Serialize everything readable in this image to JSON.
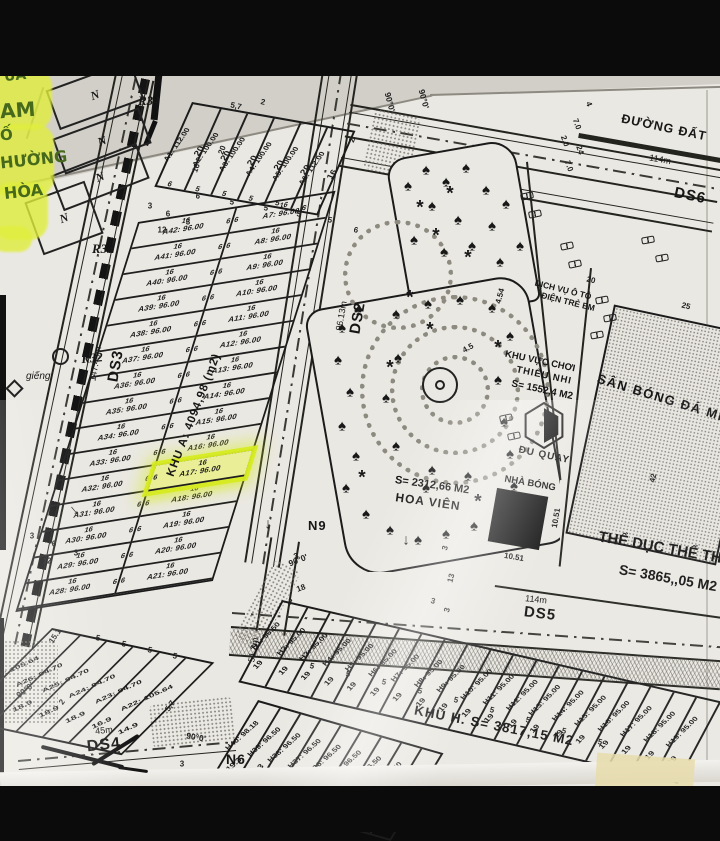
{
  "handwriting": {
    "l1": "ỦA",
    "l2": "AM",
    "l3": "Ố",
    "l4": "HƯỜNG",
    "l5": "HÒA"
  },
  "plot_marker": "N",
  "ref_labels": {
    "r34": "R34",
    "r33": "R33",
    "r32": "R32",
    "well": "giếng"
  },
  "roads": {
    "ds2": {
      "name": "DS2",
      "length": "96.13m"
    },
    "ds3": {
      "name": "DS3",
      "length": "147.43m"
    },
    "ds4": {
      "name": "DS4",
      "length": "45m"
    },
    "ds5": {
      "name": "DS5",
      "length": "114m"
    },
    "ds6": {
      "name": "DS6"
    },
    "dirt": {
      "name": "ĐƯỜNG ĐẤT",
      "length": "114m"
    },
    "n6": "N6",
    "n9": "N9",
    "len51": "51.3m"
  },
  "block_a": {
    "name": "KHU A: 4094,98 (m2)",
    "top_row": [
      {
        "label": "A1: 112.00",
        "depth": "20",
        "w": "6"
      },
      {
        "label": "A2: 100.00",
        "depth": "20",
        "w": "5"
      },
      {
        "label": "A3: 100.00",
        "depth": "20",
        "w": "5"
      },
      {
        "label": "A4: 100.00",
        "depth": "20",
        "w": "5"
      },
      {
        "label": "A5: 100.00",
        "depth": "20",
        "w": "5"
      },
      {
        "label": "A6: 112.00",
        "depth": "16",
        "w": "6"
      }
    ],
    "left_col": [
      {
        "label": "A42: 96.00",
        "w": "16",
        "d": "6"
      },
      {
        "label": "A41: 96.00",
        "w": "16",
        "d": "6"
      },
      {
        "label": "A40: 96.00",
        "w": "16",
        "d": "6"
      },
      {
        "label": "A39: 96.00",
        "w": "16",
        "d": "6"
      },
      {
        "label": "A38: 96.00",
        "w": "16",
        "d": "6"
      },
      {
        "label": "A37: 96.00",
        "w": "16",
        "d": "6"
      },
      {
        "label": "A36: 96.00",
        "w": "16",
        "d": "6"
      },
      {
        "label": "A35: 96.00",
        "w": "16",
        "d": "6"
      },
      {
        "label": "A34: 96.00",
        "w": "16",
        "d": "6"
      },
      {
        "label": "A33: 96.00",
        "w": "16",
        "d": "6"
      },
      {
        "label": "A32: 96.00",
        "w": "16",
        "d": "6"
      },
      {
        "label": "A31: 96.00",
        "w": "16",
        "d": "6"
      },
      {
        "label": "A30: 96.00",
        "w": "16",
        "d": "6"
      },
      {
        "label": "A29: 96.00",
        "w": "16",
        "d": "6"
      },
      {
        "label": "A28: 96.00",
        "w": "16",
        "d": "6"
      }
    ],
    "right_col": [
      {
        "label": "A7: 96.00",
        "w": "16",
        "d": "6"
      },
      {
        "label": "A8: 96.00",
        "w": "16",
        "d": "6"
      },
      {
        "label": "A9: 96.00",
        "w": "16",
        "d": "6"
      },
      {
        "label": "A10: 96.00",
        "w": "16",
        "d": "6"
      },
      {
        "label": "A11: 96.00",
        "w": "16",
        "d": "6"
      },
      {
        "label": "A12: 96.00",
        "w": "16",
        "d": "6"
      },
      {
        "label": "A13: 96.00",
        "w": "16",
        "d": "6"
      },
      {
        "label": "A14: 96.00",
        "w": "16",
        "d": "6"
      },
      {
        "label": "A15: 96.00",
        "w": "16",
        "d": "6"
      },
      {
        "label": "A16: 96.00",
        "w": "16",
        "d": "6"
      },
      {
        "label": "A17: 96.00",
        "w": "16",
        "d": "6",
        "cls": "hl"
      },
      {
        "label": "A18: 96.00",
        "w": "16",
        "d": "6",
        "cls": "hl2"
      },
      {
        "label": "A19: 96.00",
        "w": "16",
        "d": "6"
      },
      {
        "label": "A20: 96.00",
        "w": "16",
        "d": "6"
      },
      {
        "label": "A21: 96.00",
        "w": "16",
        "d": "6"
      }
    ],
    "diag_row": [
      {
        "label": "A27: 105.64",
        "w": "18.9"
      },
      {
        "label": "A26: 94.70",
        "w": "18.9"
      },
      {
        "label": "A25: 94.70",
        "w": "18.9"
      },
      {
        "label": "A24: 94.70",
        "w": "18.9"
      },
      {
        "label": "A23: 94.70",
        "w": "16.9"
      },
      {
        "label": "A22: 105.64",
        "w": "14.9"
      }
    ]
  },
  "block_h": {
    "name": "KHU H. S= 3817,15 M2",
    "upper_row": [
      {
        "label": "H1: 96.50",
        "w": "19"
      },
      {
        "label": "H2: 95.00",
        "w": "19"
      },
      {
        "label": "H3: 95.00",
        "w": "19"
      },
      {
        "label": "H4: 95.00",
        "w": "19"
      },
      {
        "label": "H5: 95.00",
        "w": "19"
      },
      {
        "label": "H6: 95.00",
        "w": "19"
      },
      {
        "label": "H7: 95.00",
        "w": "19"
      },
      {
        "label": "H8: 95.00",
        "w": "19"
      },
      {
        "label": "H9: 95.00",
        "w": "19"
      },
      {
        "label": "H10: 95.00",
        "w": "19"
      },
      {
        "label": "H11: 95.00",
        "w": "19"
      },
      {
        "label": "H12: 95.00",
        "w": "19"
      },
      {
        "label": "H13: 95.00",
        "w": "19"
      },
      {
        "label": "H14: 95.00",
        "w": "19"
      },
      {
        "label": "H15: 95.00",
        "w": "19"
      },
      {
        "label": "H16: 95.00",
        "w": "19"
      },
      {
        "label": "H17: 95.00",
        "w": "19"
      },
      {
        "label": "H18: 95.00",
        "w": "19"
      },
      {
        "label": "H19: 95.00",
        "w": "19"
      }
    ],
    "lower_row": [
      {
        "label": "H40: 98.18",
        "w": "19.3"
      },
      {
        "label": "H39: 96.50",
        "w": "19.3"
      },
      {
        "label": "H38: 96.50",
        "w": "19.3"
      },
      {
        "label": "H37: 96.50",
        "w": "19.3"
      },
      {
        "label": "H36: 96.50",
        "w": "19.3"
      },
      {
        "label": "H35: 96.50",
        "w": "19.3"
      },
      {
        "label": "H34: 96.50",
        "w": "19.3"
      },
      {
        "label": "H33: 96.50",
        "w": "19.3"
      },
      {
        "label": "H32: 96.50",
        "w": "19.3"
      }
    ]
  },
  "park": {
    "area": "S= 2312,66 M2",
    "name": "HOA VIÊN"
  },
  "kids": {
    "service_1": "DỊCH VỤ Ô TÔ",
    "service_2": "ĐIỆN TRẺ EM",
    "zone_1": "KHU VỰC CHƠI",
    "zone_2": "THIẾU NHI",
    "zone_area": "S= 1552,4 M2",
    "carousel": "ĐU QUAY",
    "ball_house": "NHÀ BÓNG"
  },
  "field": {
    "name": "SÂN BÓNG ĐÁ MINI"
  },
  "sport": {
    "name": "THỂ DỤC THỂ TH",
    "area": "S= 3865,,05 M2"
  },
  "decor": {
    "tree_glyph": "♠",
    "shrub_glyph": "*"
  },
  "scatter_dims": [
    {
      "t": "5,7",
      "x": 236,
      "y": 106,
      "r": 12
    },
    {
      "t": "2",
      "x": 263,
      "y": 102,
      "r": 12
    },
    {
      "t": "16",
      "x": 196,
      "y": 168,
      "r": -70
    },
    {
      "t": "20",
      "x": 222,
      "y": 150,
      "r": -70
    },
    {
      "t": "6",
      "x": 198,
      "y": 196,
      "r": 12
    },
    {
      "t": "5",
      "x": 232,
      "y": 202,
      "r": 12
    },
    {
      "t": "5",
      "x": 266,
      "y": 208,
      "r": 12
    },
    {
      "t": "5",
      "x": 299,
      "y": 214,
      "r": 12
    },
    {
      "t": "5",
      "x": 330,
      "y": 220,
      "r": 12
    },
    {
      "t": "6",
      "x": 356,
      "y": 230,
      "r": 12
    },
    {
      "t": "2",
      "x": 352,
      "y": 140,
      "r": -70
    },
    {
      "t": "3",
      "x": 150,
      "y": 206,
      "r": 0
    },
    {
      "t": "6",
      "x": 168,
      "y": 214,
      "r": 0
    },
    {
      "t": "3",
      "x": 188,
      "y": 222,
      "r": 0
    },
    {
      "t": "12",
      "x": 162,
      "y": 230,
      "r": 0
    },
    {
      "t": "3",
      "x": 32,
      "y": 536,
      "r": 0
    },
    {
      "t": "6",
      "x": 54,
      "y": 544,
      "r": 0
    },
    {
      "t": "3",
      "x": 76,
      "y": 553,
      "r": 0
    },
    {
      "t": "12",
      "x": 47,
      "y": 561,
      "r": 0
    },
    {
      "t": "3",
      "x": 296,
      "y": 556,
      "r": -20
    },
    {
      "t": "18",
      "x": 301,
      "y": 588,
      "r": -20
    },
    {
      "t": "3",
      "x": 445,
      "y": 548,
      "r": -75
    },
    {
      "t": "13",
      "x": 451,
      "y": 578,
      "r": -75
    },
    {
      "t": "3",
      "x": 447,
      "y": 610,
      "r": -75
    },
    {
      "t": "20",
      "x": 591,
      "y": 280,
      "r": 14
    },
    {
      "t": "25",
      "x": 686,
      "y": 306,
      "r": 14
    },
    {
      "t": "42",
      "x": 653,
      "y": 478,
      "r": -78
    },
    {
      "t": "4",
      "x": 589,
      "y": 104,
      "r": 70
    },
    {
      "t": "7.0",
      "x": 577,
      "y": 124,
      "r": 70
    },
    {
      "t": "2.0",
      "x": 565,
      "y": 141,
      "r": 70
    },
    {
      "t": "24",
      "x": 580,
      "y": 150,
      "r": 70
    },
    {
      "t": "7.0",
      "x": 569,
      "y": 166,
      "r": 70
    },
    {
      "t": "4.54",
      "x": 500,
      "y": 296,
      "r": -75
    },
    {
      "t": "4.5",
      "x": 468,
      "y": 348,
      "r": -30
    },
    {
      "t": "10.51",
      "x": 556,
      "y": 518,
      "r": -80
    },
    {
      "t": "10.51",
      "x": 514,
      "y": 557,
      "r": 10
    },
    {
      "t": "5",
      "x": 312,
      "y": 666,
      "r": 14
    },
    {
      "t": "5",
      "x": 348,
      "y": 674,
      "r": 14
    },
    {
      "t": "5",
      "x": 384,
      "y": 682,
      "r": 14
    },
    {
      "t": "5",
      "x": 420,
      "y": 691,
      "r": 14
    },
    {
      "t": "5",
      "x": 456,
      "y": 700,
      "r": 14
    },
    {
      "t": "5",
      "x": 492,
      "y": 710,
      "r": 14
    },
    {
      "t": "5",
      "x": 528,
      "y": 720,
      "r": 14
    },
    {
      "t": "5",
      "x": 564,
      "y": 731,
      "r": 14
    },
    {
      "t": "5",
      "x": 600,
      "y": 742,
      "r": 14
    },
    {
      "t": "3",
      "x": 290,
      "y": 602,
      "r": 14
    },
    {
      "t": "3",
      "x": 433,
      "y": 601,
      "r": 14
    },
    {
      "t": "15.1",
      "x": 55,
      "y": 636,
      "r": -55
    },
    {
      "t": "5",
      "x": 98,
      "y": 638,
      "r": 12
    },
    {
      "t": "5",
      "x": 124,
      "y": 644,
      "r": 12
    },
    {
      "t": "5",
      "x": 150,
      "y": 650,
      "r": 12
    },
    {
      "t": "5",
      "x": 175,
      "y": 656,
      "r": 12
    },
    {
      "t": "2",
      "x": 62,
      "y": 702,
      "r": -55
    },
    {
      "t": "5,7",
      "x": 170,
      "y": 706,
      "r": -55
    },
    {
      "t": "3",
      "x": 182,
      "y": 764,
      "r": 0
    }
  ],
  "angles": [
    {
      "t": "90°0'",
      "x": 390,
      "y": 102,
      "r": 75
    },
    {
      "t": "90°0'",
      "x": 424,
      "y": 99,
      "r": 75
    },
    {
      "t": "90°0'",
      "x": 298,
      "y": 560,
      "r": -22
    },
    {
      "t": "90°0'",
      "x": 25,
      "y": 690,
      "r": -38
    },
    {
      "t": "90°0'",
      "x": 196,
      "y": 737,
      "r": 10
    }
  ],
  "arrows": [
    {
      "t": "↓",
      "x": 268,
      "y": 524,
      "r": 0
    },
    {
      "t": "↓",
      "x": 406,
      "y": 540,
      "r": 0
    },
    {
      "t": "↓",
      "x": 74,
      "y": 510,
      "r": -40
    }
  ],
  "trees": [
    {
      "x": 408,
      "y": 186
    },
    {
      "x": 426,
      "y": 170
    },
    {
      "x": 446,
      "y": 182
    },
    {
      "x": 466,
      "y": 168
    },
    {
      "x": 486,
      "y": 190
    },
    {
      "x": 432,
      "y": 206
    },
    {
      "x": 458,
      "y": 220
    },
    {
      "x": 414,
      "y": 240
    },
    {
      "x": 444,
      "y": 252
    },
    {
      "x": 472,
      "y": 246
    },
    {
      "x": 492,
      "y": 226
    },
    {
      "x": 506,
      "y": 204
    },
    {
      "x": 520,
      "y": 246
    },
    {
      "x": 500,
      "y": 262
    },
    {
      "x": 342,
      "y": 328
    },
    {
      "x": 358,
      "y": 310
    },
    {
      "x": 338,
      "y": 360
    },
    {
      "x": 350,
      "y": 392
    },
    {
      "x": 342,
      "y": 426
    },
    {
      "x": 356,
      "y": 456
    },
    {
      "x": 346,
      "y": 488
    },
    {
      "x": 366,
      "y": 514
    },
    {
      "x": 390,
      "y": 530
    },
    {
      "x": 418,
      "y": 540
    },
    {
      "x": 446,
      "y": 534
    },
    {
      "x": 474,
      "y": 526
    },
    {
      "x": 500,
      "y": 512
    },
    {
      "x": 514,
      "y": 486
    },
    {
      "x": 510,
      "y": 454
    },
    {
      "x": 504,
      "y": 422
    },
    {
      "x": 396,
      "y": 314
    },
    {
      "x": 428,
      "y": 304
    },
    {
      "x": 460,
      "y": 300
    },
    {
      "x": 492,
      "y": 308
    },
    {
      "x": 510,
      "y": 336
    },
    {
      "x": 398,
      "y": 358
    },
    {
      "x": 386,
      "y": 398
    },
    {
      "x": 396,
      "y": 446
    },
    {
      "x": 426,
      "y": 488
    },
    {
      "x": 468,
      "y": 476
    },
    {
      "x": 498,
      "y": 380
    },
    {
      "x": 432,
      "y": 470
    }
  ],
  "shrubs": [
    {
      "x": 420,
      "y": 208
    },
    {
      "x": 450,
      "y": 194
    },
    {
      "x": 436,
      "y": 236
    },
    {
      "x": 468,
      "y": 258
    },
    {
      "x": 410,
      "y": 298
    },
    {
      "x": 430,
      "y": 330
    },
    {
      "x": 390,
      "y": 368
    },
    {
      "x": 478,
      "y": 502
    },
    {
      "x": 362,
      "y": 478
    },
    {
      "x": 498,
      "y": 348
    }
  ],
  "benches": [
    {
      "x": 527,
      "y": 196,
      "r": -12
    },
    {
      "x": 535,
      "y": 214,
      "r": -12
    },
    {
      "x": 567,
      "y": 246,
      "r": -12
    },
    {
      "x": 575,
      "y": 264,
      "r": -12
    },
    {
      "x": 602,
      "y": 300,
      "r": -10
    },
    {
      "x": 610,
      "y": 318,
      "r": -10
    },
    {
      "x": 648,
      "y": 240,
      "r": -10
    },
    {
      "x": 662,
      "y": 258,
      "r": -10
    },
    {
      "x": 506,
      "y": 418,
      "r": -12
    },
    {
      "x": 514,
      "y": 436,
      "r": -12
    },
    {
      "x": 597,
      "y": 335,
      "r": -10
    }
  ]
}
